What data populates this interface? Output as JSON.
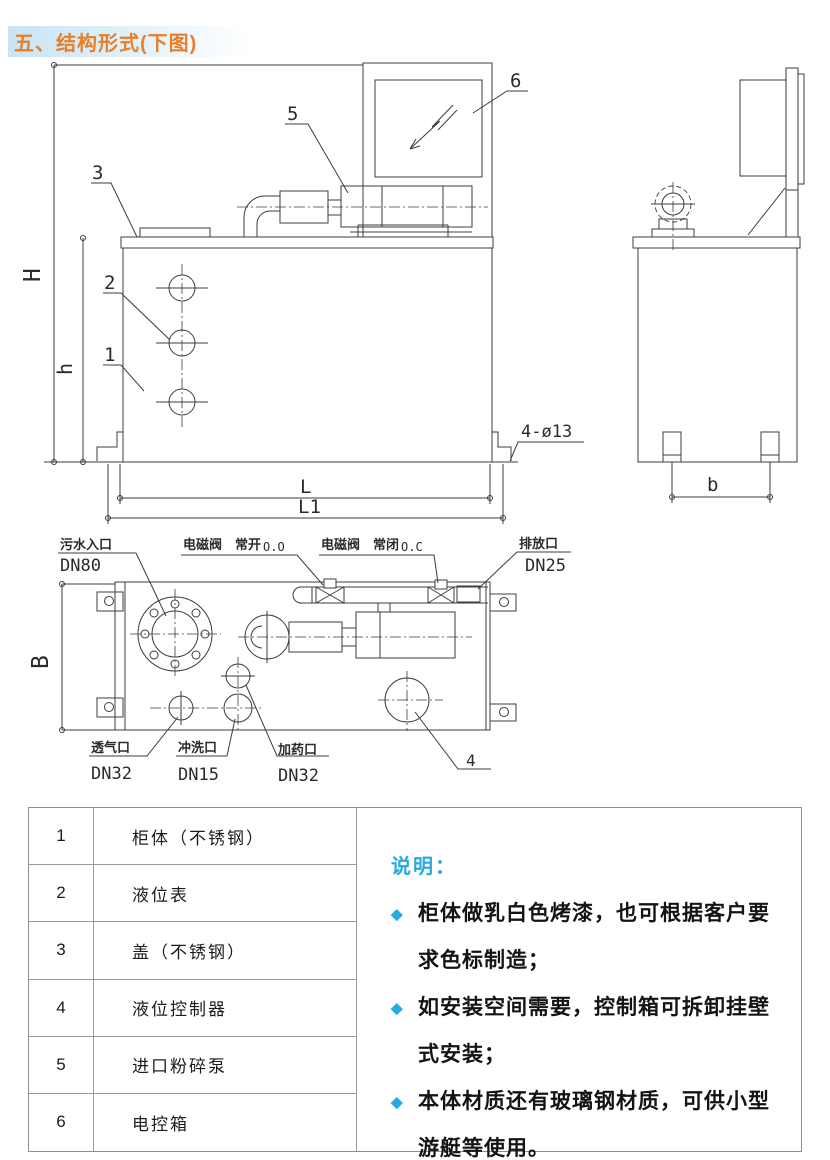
{
  "title": "五、结构形式(下图)",
  "drawing": {
    "dims": {
      "H": "H",
      "h": "h",
      "L": "L",
      "L1": "L1",
      "b": "b",
      "B": "B",
      "holes": "4-ø13"
    },
    "callouts": {
      "n1": "1",
      "n2": "2",
      "n3": "3",
      "n4": "4",
      "n5": "5",
      "n6": "6"
    },
    "ports": {
      "inlet_name": "污水入口",
      "inlet_dn": "DN80",
      "valve_word": "电磁阀",
      "valve_open": "常开",
      "valve_open_code": "O.O",
      "valve_word2": "电磁阀",
      "valve_closed": "常闭",
      "valve_closed_code": "O.C",
      "drain_name": "排放口",
      "drain_dn": "DN25",
      "vent_name": "透气口",
      "vent_dn": "DN32",
      "flush_name": "冲洗口",
      "flush_dn": "DN15",
      "dosing_name": "加药口",
      "dosing_dn": "DN32"
    }
  },
  "parts_table": {
    "rows": [
      {
        "no": "1",
        "name": "柜体（不锈钢）"
      },
      {
        "no": "2",
        "name": "液位表"
      },
      {
        "no": "3",
        "name": "盖（不锈钢）"
      },
      {
        "no": "4",
        "name": "液位控制器"
      },
      {
        "no": "5",
        "name": "进口粉碎泵"
      },
      {
        "no": "6",
        "name": "电控箱"
      }
    ]
  },
  "notes": {
    "heading": "说明：",
    "bullet_icon": "◆",
    "items": [
      "柜体做乳白色烤漆，也可根据客户要求色标制造；",
      "如安装空间需要，控制箱可拆卸挂壁式安装；",
      "本体材质还有玻璃钢材质，可供小型游艇等使用。"
    ]
  },
  "colors": {
    "accent_orange": "#e87f2b",
    "accent_cyan": "#2aa9e0",
    "line": "#3c3c3c",
    "table_border": "#8f8f8f",
    "title_bg": "#c8e4f4"
  }
}
